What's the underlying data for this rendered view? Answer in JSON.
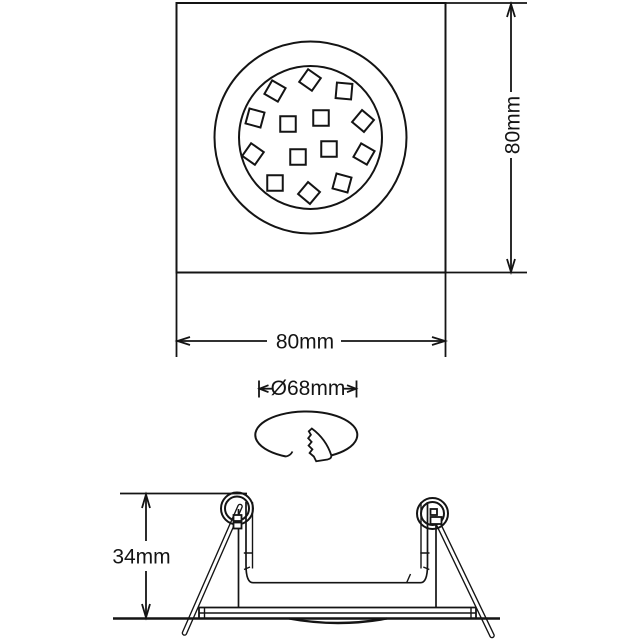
{
  "drawing": {
    "background_color": "#ffffff",
    "line_color": "#141414",
    "views": {
      "top_view": {
        "width_label": "80mm",
        "height_label": "80mm",
        "led_chip_size": 15.5,
        "led_modules": [
          {
            "x": 310,
            "y": 80,
            "rot": 35
          },
          {
            "x": 275,
            "y": 91,
            "rot": 30
          },
          {
            "x": 344,
            "y": 91,
            "rot": 5
          },
          {
            "x": 255,
            "y": 118,
            "rot": 15
          },
          {
            "x": 288,
            "y": 124,
            "rot": 0
          },
          {
            "x": 321,
            "y": 118,
            "rot": 0
          },
          {
            "x": 363,
            "y": 121,
            "rot": 40
          },
          {
            "x": 253,
            "y": 154,
            "rot": 35
          },
          {
            "x": 298,
            "y": 157,
            "rot": 0
          },
          {
            "x": 329,
            "y": 149,
            "rot": 0
          },
          {
            "x": 364,
            "y": 154,
            "rot": 30
          },
          {
            "x": 275,
            "y": 183,
            "rot": 0
          },
          {
            "x": 309,
            "y": 193,
            "rot": 40
          },
          {
            "x": 342,
            "y": 183,
            "rot": 15
          }
        ]
      },
      "cutout": {
        "diameter_label": "Ø68mm"
      },
      "side_view": {
        "depth_label": "34mm"
      }
    }
  }
}
